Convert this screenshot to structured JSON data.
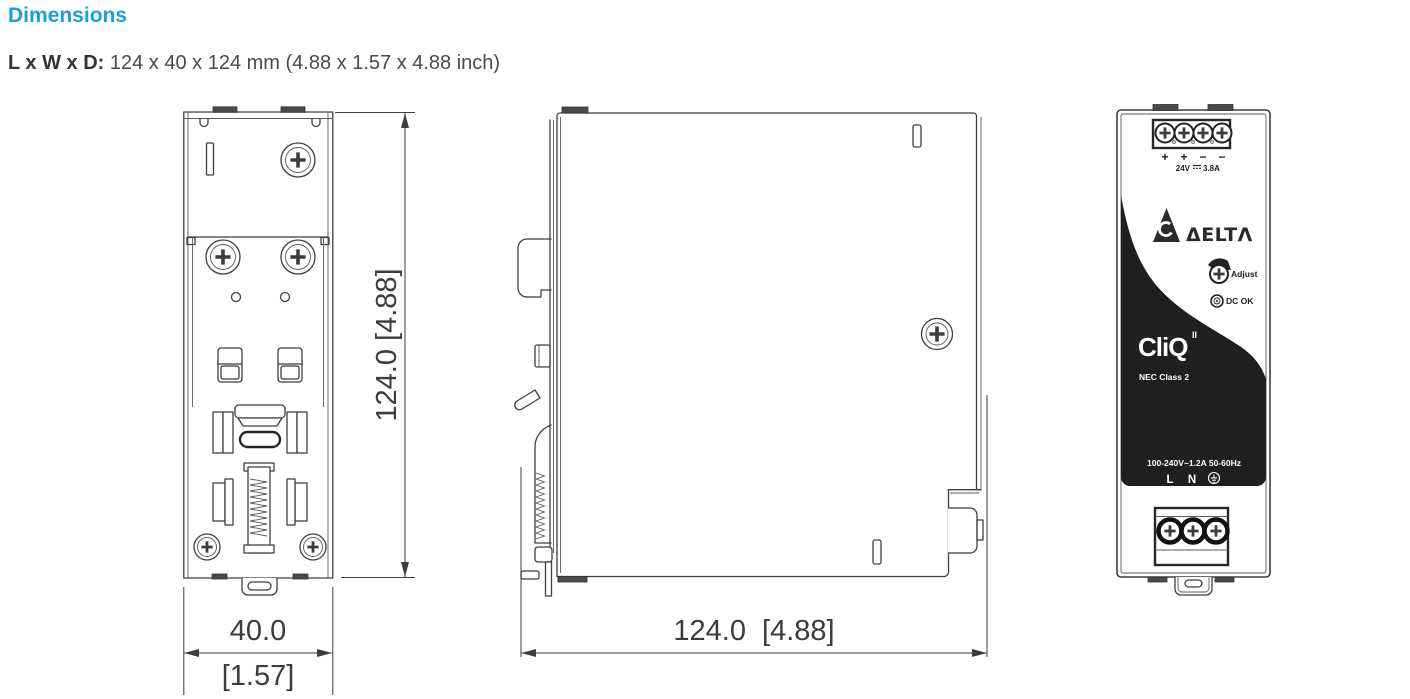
{
  "header": {
    "title": "Dimensions",
    "dims_label": "L x W x D:",
    "dims_value": " 124 x 40 x 124 mm (4.88 x 1.57 x 4.88 inch)"
  },
  "colors": {
    "accent": "#1b9fdf",
    "line": "#3f3f3f",
    "panel_black": "#1f1f1f"
  },
  "views": {
    "back": {
      "height_dim": "124.0 [4.88]",
      "width_mm": "40.0",
      "width_inch": "[1.57]"
    },
    "side": {
      "depth_dim": "124.0  [4.88]"
    },
    "front": {
      "output_terminals": [
        "+",
        "+",
        "−",
        "−"
      ],
      "output_v": "24V",
      "output_a": "3.8A",
      "brand": "ΔELTΛ",
      "adjust": "Adjust",
      "dc_ok": "DC OK",
      "product": "CliQ",
      "product_sup": "II",
      "nec": "NEC Class 2",
      "input_rating": "100-240V~1.2A 50-60Hz",
      "term_l": "L",
      "term_n": "N"
    }
  }
}
